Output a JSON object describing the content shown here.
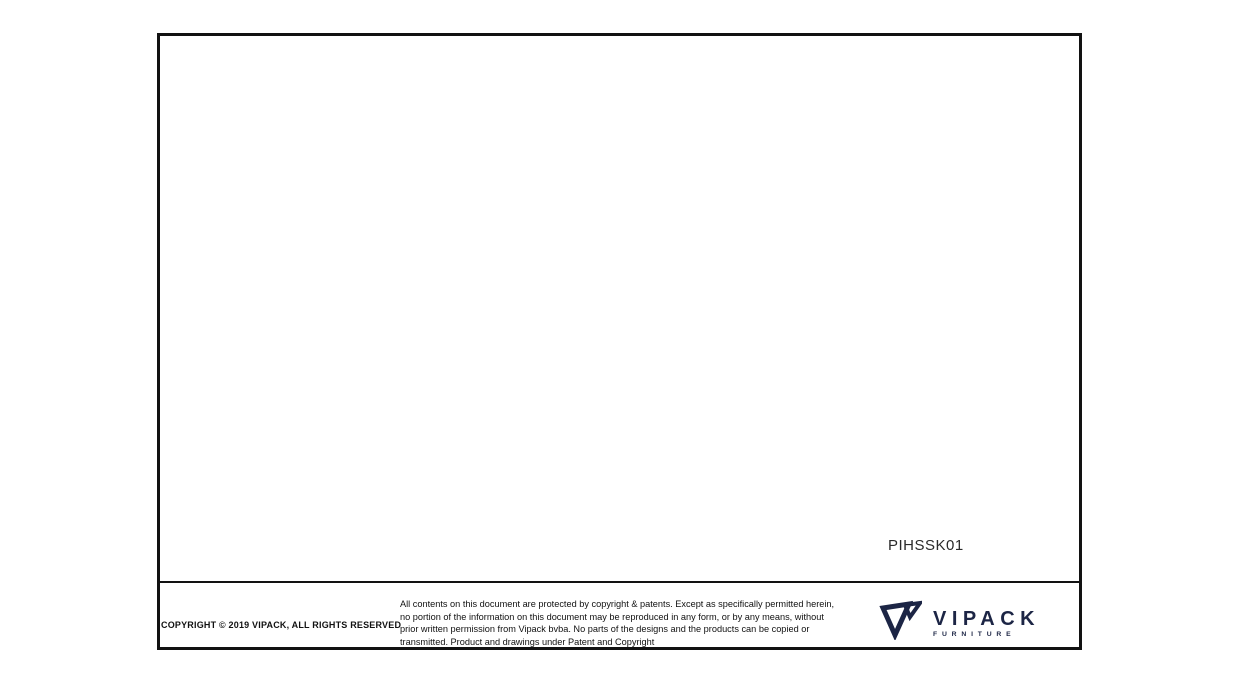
{
  "drawing": {
    "product_code": "PIHSSK01",
    "dim_length": "240mm",
    "dim_bracket_width": "50mm",
    "dim_bracket_height": "24mm",
    "dim_height": "85mm",
    "dim_diameter": "DIA 20mm"
  },
  "footer": {
    "copyright": "COPYRIGHT  © 2019 VIPACK, ALL RIGHTS RESERVED",
    "legal_line1": "All contents on this document are protected by copyright & patents. Except as specifically permitted herein,",
    "legal_line2": "no portion of the information on this document may be reproduced in any form, or by any means, without",
    "legal_line3": "prior written permission from Vipack bvba. No parts of the designs and the products can be copied or",
    "legal_line4": "transmitted. Product and drawings under Patent and Copyright",
    "brand_name": "VIPACK",
    "brand_subtitle": "FURNITURE"
  },
  "colors": {
    "brand_navy": "#1c2545",
    "frame_border": "#121212",
    "dimension_line": "#555555",
    "object_edge": "#8f8f8f"
  }
}
